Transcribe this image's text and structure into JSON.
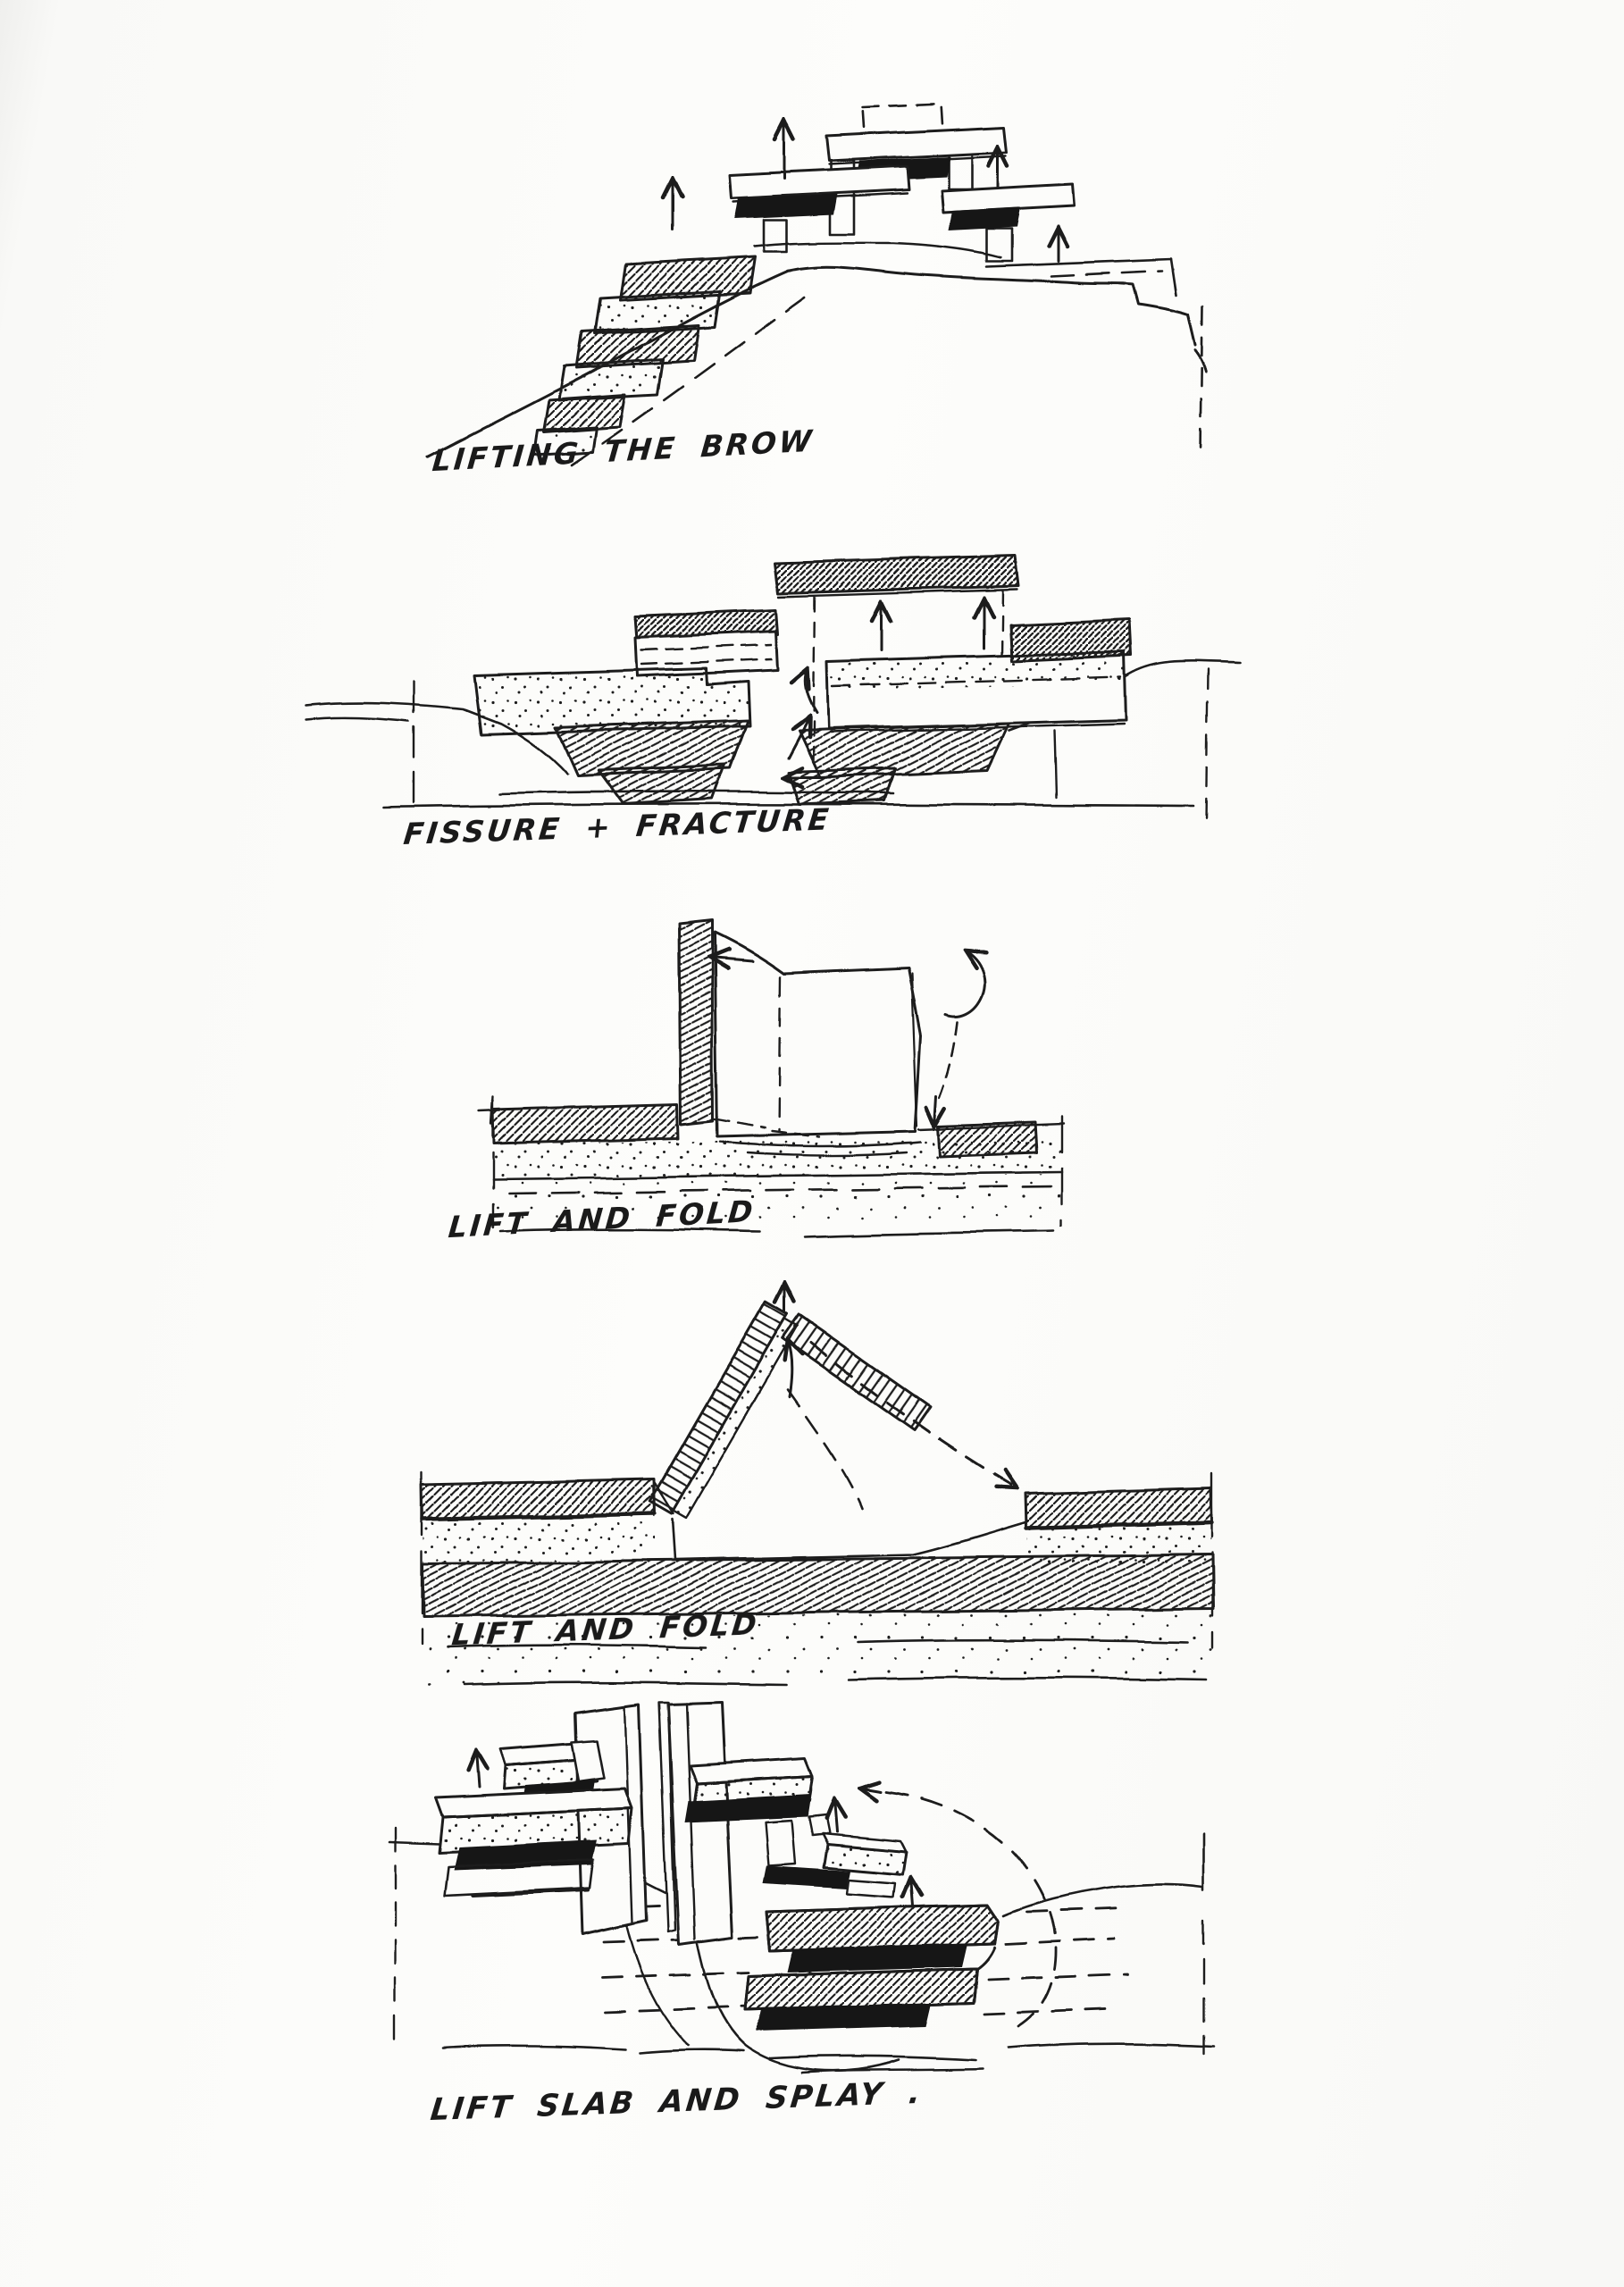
{
  "page": {
    "paper_color": "#fcfcfa",
    "ink_color": "#1c1c1c",
    "media": "hand-drawn architectural concept sketches, black ink on white paper"
  },
  "figures": [
    {
      "id": "lifting-the-brow",
      "caption": "LIFTING THE BROW"
    },
    {
      "id": "fissure-and-fracture",
      "caption": "FISSURE + FRACTURE"
    },
    {
      "id": "lift-and-fold-1",
      "caption": "LIFT AND FOLD"
    },
    {
      "id": "lift-and-fold-2",
      "caption": "LIFT AND FOLD"
    },
    {
      "id": "lift-slab-and-splay",
      "caption": "LIFT SLAB AND SPLAY ."
    }
  ]
}
